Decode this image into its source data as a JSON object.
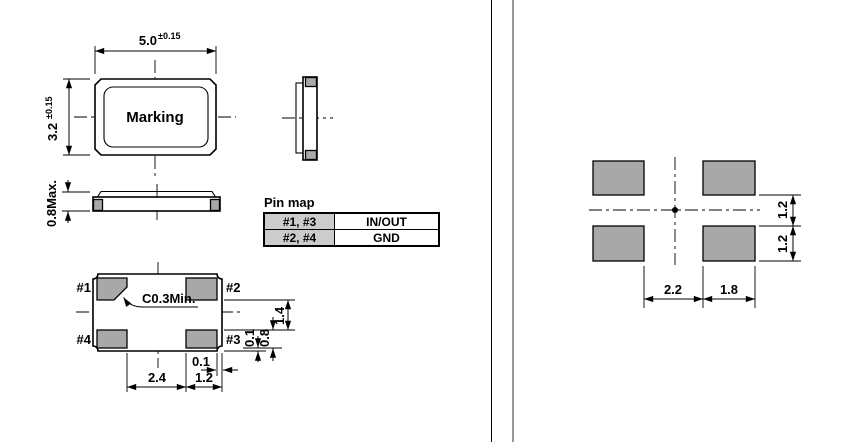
{
  "colors": {
    "pad_fill": "#a8a8a8",
    "table_header_fill": "#cccccc",
    "line": "#000000",
    "divider_line": "#999999",
    "background": "#ffffff"
  },
  "top_view": {
    "width": "5.0",
    "width_tol": "±0.15",
    "height": "3.2",
    "height_tol": "±0.15",
    "marking": "Marking"
  },
  "front_view": {
    "max_height": "0.8Max."
  },
  "bottom_view": {
    "pin1": "#1",
    "pin2": "#2",
    "pin3": "#3",
    "pin4": "#4",
    "chamfer_note": "C0.3Min.",
    "dim_pad_pitch": "2.4",
    "dim_pad_width": "1.2",
    "dim_edge_offset_h": "0.1",
    "dim_pad_gap_v": "1.4",
    "dim_pad_height": "0.8",
    "dim_edge_offset_v": "0.1"
  },
  "pin_map": {
    "title": "Pin map",
    "rows": [
      {
        "pins": "#1, #3",
        "function": "IN/OUT"
      },
      {
        "pins": "#2, #4",
        "function": "GND"
      }
    ]
  },
  "land_pattern": {
    "dim_pad_gap_h": "2.2",
    "dim_pad_width": "1.8",
    "dim_pad_gap_v": "1.2",
    "dim_pad_height": "1.2"
  }
}
